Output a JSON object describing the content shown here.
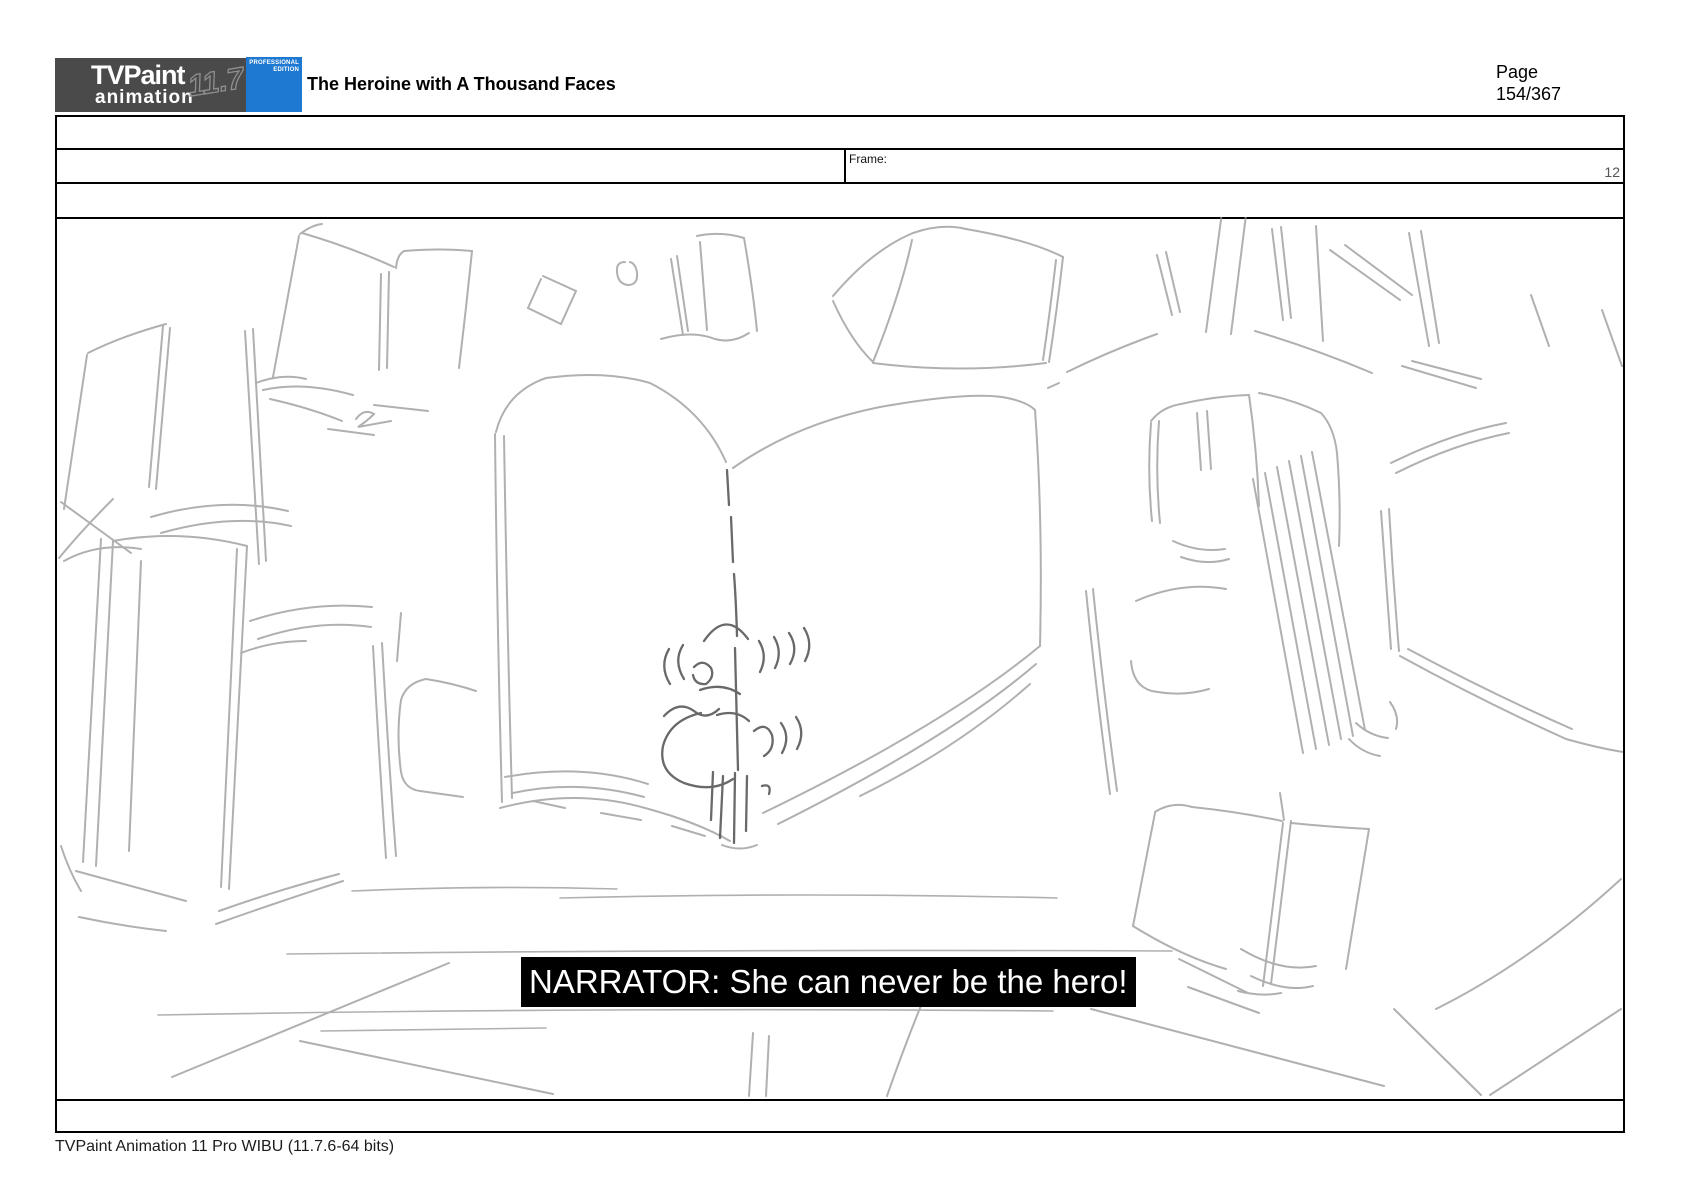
{
  "header": {
    "logo": {
      "brand_top": "TVPaint",
      "brand_bottom": "animation",
      "version": "11.7",
      "edition_line1": "PROFESSIONAL",
      "edition_line2": "EDITION",
      "dark_bg": "#4a4a4a",
      "blue_bg": "#1e79d2"
    },
    "title": "The Heroine with A Thousand Faces",
    "page_label": "Page",
    "page_number": "154/367"
  },
  "info_table": {
    "frame_label": "Frame:",
    "frame_value": "12"
  },
  "panel": {
    "caption": "NARRATOR: She can never be the hero!",
    "caption_bg": "#000000",
    "caption_color": "#ffffff",
    "sketch_stroke_light": "#969696",
    "sketch_stroke_dark": "#4f4f4f",
    "sketch_description": "pencil storyboard sketch: tiny figure standing on a large open book surrounded by scattered books"
  },
  "footer": {
    "app_info": "TVPaint Animation 11 Pro WIBU (11.7.6-64 bits)"
  }
}
